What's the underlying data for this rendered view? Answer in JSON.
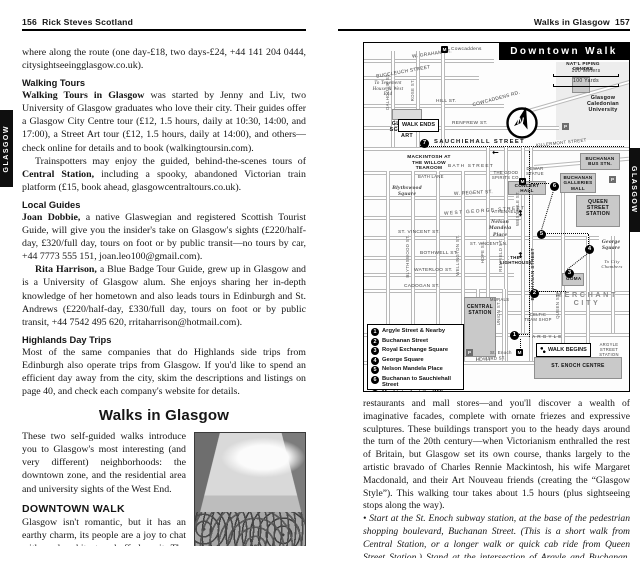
{
  "left_page": {
    "page_number": "156",
    "book_title": "Rick Steves Scotland",
    "side_tab": "GLASGOW",
    "intro_continuation": "where along the route (one day-£18, two days-£24, +44 141 204 0444, citysightseeingglasgow.co.uk).",
    "walking_tours": {
      "heading": "Walking Tours",
      "lead": "Walking Tours in Glasgow",
      "body": " was started by Jenny and Liv, two University of Glasgow graduates who love their city. Their guides offer a Glasgow City Centre tour (£12, 1.5 hours, daily at 10:30, 14:00, and 17:00), a Street Art tour (£12, 1.5 hours, daily at 14:00), and others—check online for details and to book (walkingtoursin.com).",
      "train_a": "Trainspotters may enjoy the guided, behind-the-scenes tours of ",
      "train_b": "Central Station,",
      "train_c": " including a spooky, abandoned Victorian train platform (£15, book ahead, glasgowcentraltours.co.uk)."
    },
    "local_guides": {
      "heading": "Local Guides",
      "joan_lead": "Joan Dobbie,",
      "joan_body": " a native Glaswegian and registered Scottish Tourist Guide, will give you the insider's take on Glasgow's sights (£220/half-day, £320/full day, tours on foot or by public transit—no tours by car, +44 7773 555 151, joan.leo100@gmail.com).",
      "rita_lead": "Rita Harrison,",
      "rita_body": " a Blue Badge Tour Guide, grew up in Glasgow and is a University of Glasgow alum. She enjoys sharing her in-depth knowledge of her hometown and also leads tours in Edinburgh and St. Andrews (£220/half-day, £330/full day, tours on foot or by public transit, +44 7542 495 620, rritaharrison@hotmail.com)."
    },
    "highlands": {
      "heading": "Highlands Day Trips",
      "body": "Most of the same companies that do Highlands side trips from Edinburgh also operate trips from Glasgow. If you'd like to spend an efficient day away from the city, skim the descriptions and listings on page 40, and check each company's website for details."
    },
    "walks_section": {
      "heading": "Walks in Glasgow",
      "body": "These two self-guided walks introduce you to Glasgow's most interesting (and very different) neighborhoods: the downtown zone, and the residential area and university sights of the West End.",
      "downtown_heading": "DOWNTOWN WALK",
      "downtown_body": "Glasgow isn't romantic, but it has an earthy charm, its people are a joy to chat with, and architecture buffs love it. The more time you spend here, the more you'll appreciate the edgy, artsy vibe and the quirky, fun-loving spirit. Be sure to look up—above the chain"
    }
  },
  "right_page": {
    "header_title": "Walks in Glasgow",
    "page_number": "157",
    "side_tab": "GLASGOW",
    "body_1": "restaurants and mall stores—and you'll discover a wealth of imaginative facades, complete with ornate friezes and expressive sculptures. These buildings transport you to the heady days around the turn of the 20th century—when Victorianism enthralled the rest of Britain, but Glasgow set its own course, thanks largely to the artistic bravado of Charles Rennie Mackintosh, his wife Margaret Macdonald, and their Art Nouveau friends (creating the “Glasgow Style”). This walking tour takes about 1.5 hours (plus sightseeing stops along the way).",
    "body_2": "• Start at the St. Enoch subway station, at the base of the pedestrian shopping boulevard, Buchanan Street. (This is a short walk from Central Station, or a longer walk or quick cab ride from Queen Street Station.) Stand at the intersection of Argyle and Buchanan, where the"
  },
  "map": {
    "title": "Downtown Walk",
    "scale_meters": "100 Meters",
    "scale_yards": "100 Yards",
    "compass_letter": "N",
    "legend": [
      {
        "num": "1",
        "label": "Argyle Street & Nearby"
      },
      {
        "num": "2",
        "label": "Buchanan Street"
      },
      {
        "num": "3",
        "label": "Royal Exchange Square"
      },
      {
        "num": "4",
        "label": "George Square"
      },
      {
        "num": "5",
        "label": "Nelson Mandela Place"
      },
      {
        "num": "6",
        "label": "Buchanan to Sauchiehall Street"
      },
      {
        "num": "7",
        "label": "Mackintosh at the Willow Tearoom"
      }
    ],
    "stops": [
      "1",
      "2",
      "3",
      "4",
      "5",
      "6",
      "7"
    ],
    "labels": {
      "cowcaddens_station": "Cowcaddens",
      "w_graham": "W. GRAHAM ST.",
      "buccleuch": "BUCCLEUCH STREET",
      "to_tenement": "To Tenement House & West End",
      "hill_st": "HILL ST.",
      "glasgow_school_of_art": "GLASGOW SCHOOL OF ART",
      "renfrew_st": "RENFREW ST.",
      "walk_ends": "WALK ENDS",
      "willow_tearoom": "MACKINTOSH AT THE WILLOW TEAROOM",
      "sauchiehall": "SAUCHIEHALL STREET",
      "bath_street": "BATH STREET",
      "bath_lane": "BATH LANE",
      "natl_piping": "NAT’L PIPING CENTRE",
      "cowcaddens_rd": "COWCADDENS RD.",
      "caledonian_university": "Glasgow Caledonian University",
      "killermont": "KILLERMONT STREET",
      "buchanan_bus": "BUCHANAN BUS STN.",
      "concert_hall": "CONCERT HALL",
      "dewar_statue": "DEWAR STATUE",
      "buchanan_galleries": "BUCHANAN GALLERIES MALL",
      "good_spirits": "THE GOOD SPIRITS CO.",
      "blythswood_square": "Blythswood Square",
      "w_regent": "W. REGENT ST.",
      "west_george": "WEST GEORGE STREET",
      "st_vincent": "ST. VINCENT ST.",
      "st_vincent_ln": "ST. VINCENT LN.",
      "bothwell": "BOTHWELL ST.",
      "waterloo": "WATERLOO ST.",
      "cadogan": "CADOGAN ST.",
      "queen_street_station": "QUEEN STREET STATION",
      "athenaeum": "ATHENAEUM",
      "nelson_mandela": "Nelson Mandela Place",
      "george_square": "George Square",
      "city_chambers": "To City Chambers",
      "lighthouse": "THE LIGHTHOUSE",
      "merchant_city": "MERCHANT CITY",
      "goma": "GOMA",
      "celtic_shop": "CELTIC TEAM SHOP",
      "murals": "MURALS",
      "central_station": "CENTRAL STATION",
      "walk_begins": "WALK BEGINS",
      "st_enoch_station": "St. Enoch",
      "st_enoch_centre": "ST. ENOCH CENTRE",
      "argyle_street_station": "ARGYLE STREET STATION",
      "argyle": "ARGYLE",
      "howard": "HOWARD ST.",
      "dalhousie": "DALHOUSIE ST.",
      "rose": "ROSE ST.",
      "hope": "HOPE ST.",
      "renfield": "RENFIELD ST.",
      "west_nile": "WEST NILE ST.",
      "blythswood_st_v": "BLYTHSWOOD ST.",
      "wellington_st_v": "WELLINGTON ST.",
      "buchanan_street_v": "BUCHANAN STREET",
      "queen_st_v": "QUEEN ST.",
      "union_st_v": "UNION ST.",
      "metro_m": "M",
      "parking_p": "P",
      "arrow_left": "←",
      "arrow_updown": "↕"
    }
  }
}
